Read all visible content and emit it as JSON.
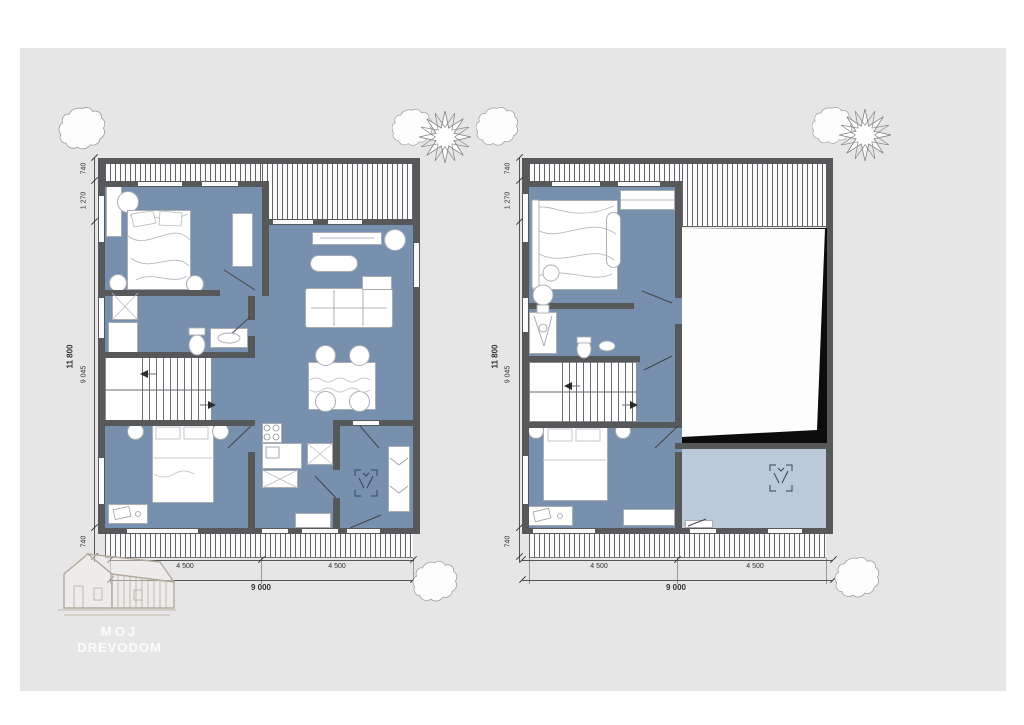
{
  "logo": {
    "line1": "MOJ",
    "line2": "DREVODOM"
  },
  "colors": {
    "paper": "#e6e6e6",
    "room_blue": "#7690ad",
    "gallery_blue": "#bcc9d9",
    "wall": "#57585a",
    "void_shadow": "#0c0c0c",
    "dim_text": "#333333"
  },
  "plans": {
    "left": {
      "v_total": "11 800",
      "v_segments": [
        "740",
        "1 270",
        "9 045",
        "740"
      ],
      "h_segments": [
        "4 500",
        "4 500"
      ],
      "h_total": "9 000"
    },
    "right": {
      "v_total": "11 800",
      "v_segments": [
        "740",
        "1 270",
        "9 045",
        "740"
      ],
      "h_segments": [
        "4 500",
        "4 500"
      ],
      "h_total": "9 000"
    }
  }
}
